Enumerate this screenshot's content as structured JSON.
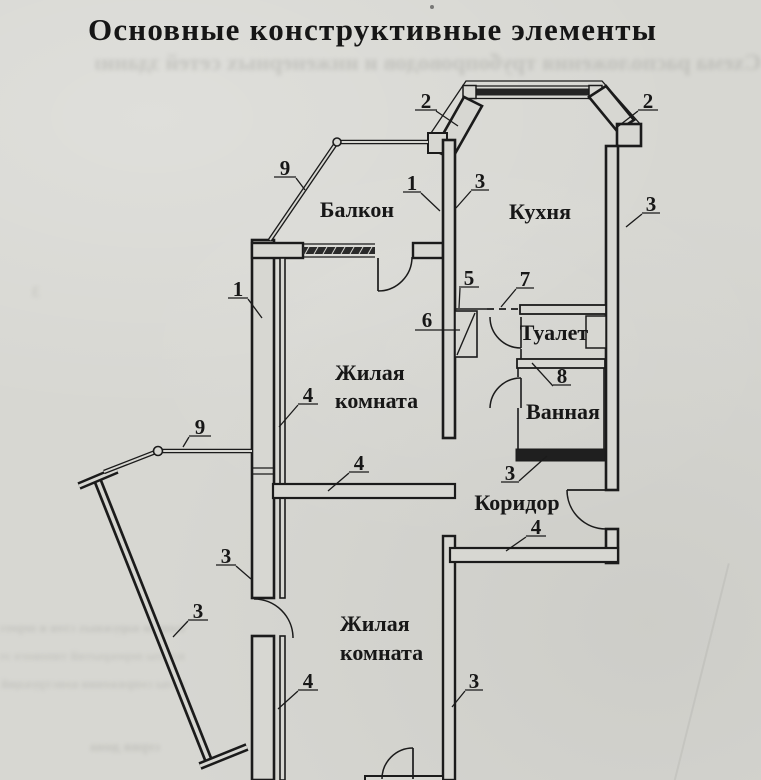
{
  "title": "Основные конструктивные элементы",
  "bleed_through": {
    "line1": "Схема расположения трубопроводов и инженерных сетей здания",
    "line2": "панели наружных стен и перегородки",
    "line3": "плиты перекрытий типового этажа",
    "line4": "узлы сопряжения конструкций",
    "line5": "серия дома",
    "line6": "3"
  },
  "rooms": {
    "balcony": "Балкон",
    "kitchen": "Кухня",
    "living1_line1": "Жилая",
    "living1_line2": "комната",
    "toilet": "Туалет",
    "bathroom": "Ванная",
    "corridor": "Коридор",
    "living2_line1": "Жилая",
    "living2_line2": "комната"
  },
  "callouts": [
    {
      "n": "2",
      "target": "bay-corner-left"
    },
    {
      "n": "2",
      "target": "bay-corner-right"
    },
    {
      "n": "9",
      "target": "balcony-railing-top"
    },
    {
      "n": "1",
      "target": "wall-balcony-kitchen"
    },
    {
      "n": "3",
      "target": "wall-kitchen-left"
    },
    {
      "n": "3",
      "target": "wall-kitchen-right"
    },
    {
      "n": "1",
      "target": "outer-wall-left"
    },
    {
      "n": "5",
      "target": "partition-line"
    },
    {
      "n": "7",
      "target": "dashed-joint"
    },
    {
      "n": "6",
      "target": "vent-shaft"
    },
    {
      "n": "8",
      "target": "toilet-bath-partition"
    },
    {
      "n": "4",
      "target": "inner-wall-living1"
    },
    {
      "n": "9",
      "target": "balcony-railing-bottom"
    },
    {
      "n": "4",
      "target": "partition-living1-bottom"
    },
    {
      "n": "3",
      "target": "bathroom-bottom-wall"
    },
    {
      "n": "4",
      "target": "corridor-wall"
    },
    {
      "n": "3",
      "target": "outer-wall-left-lower"
    },
    {
      "n": "3",
      "target": "balcony2-railing"
    },
    {
      "n": "4",
      "target": "inner-wall-living2"
    },
    {
      "n": "3",
      "target": "wall-living2-right"
    }
  ]
}
